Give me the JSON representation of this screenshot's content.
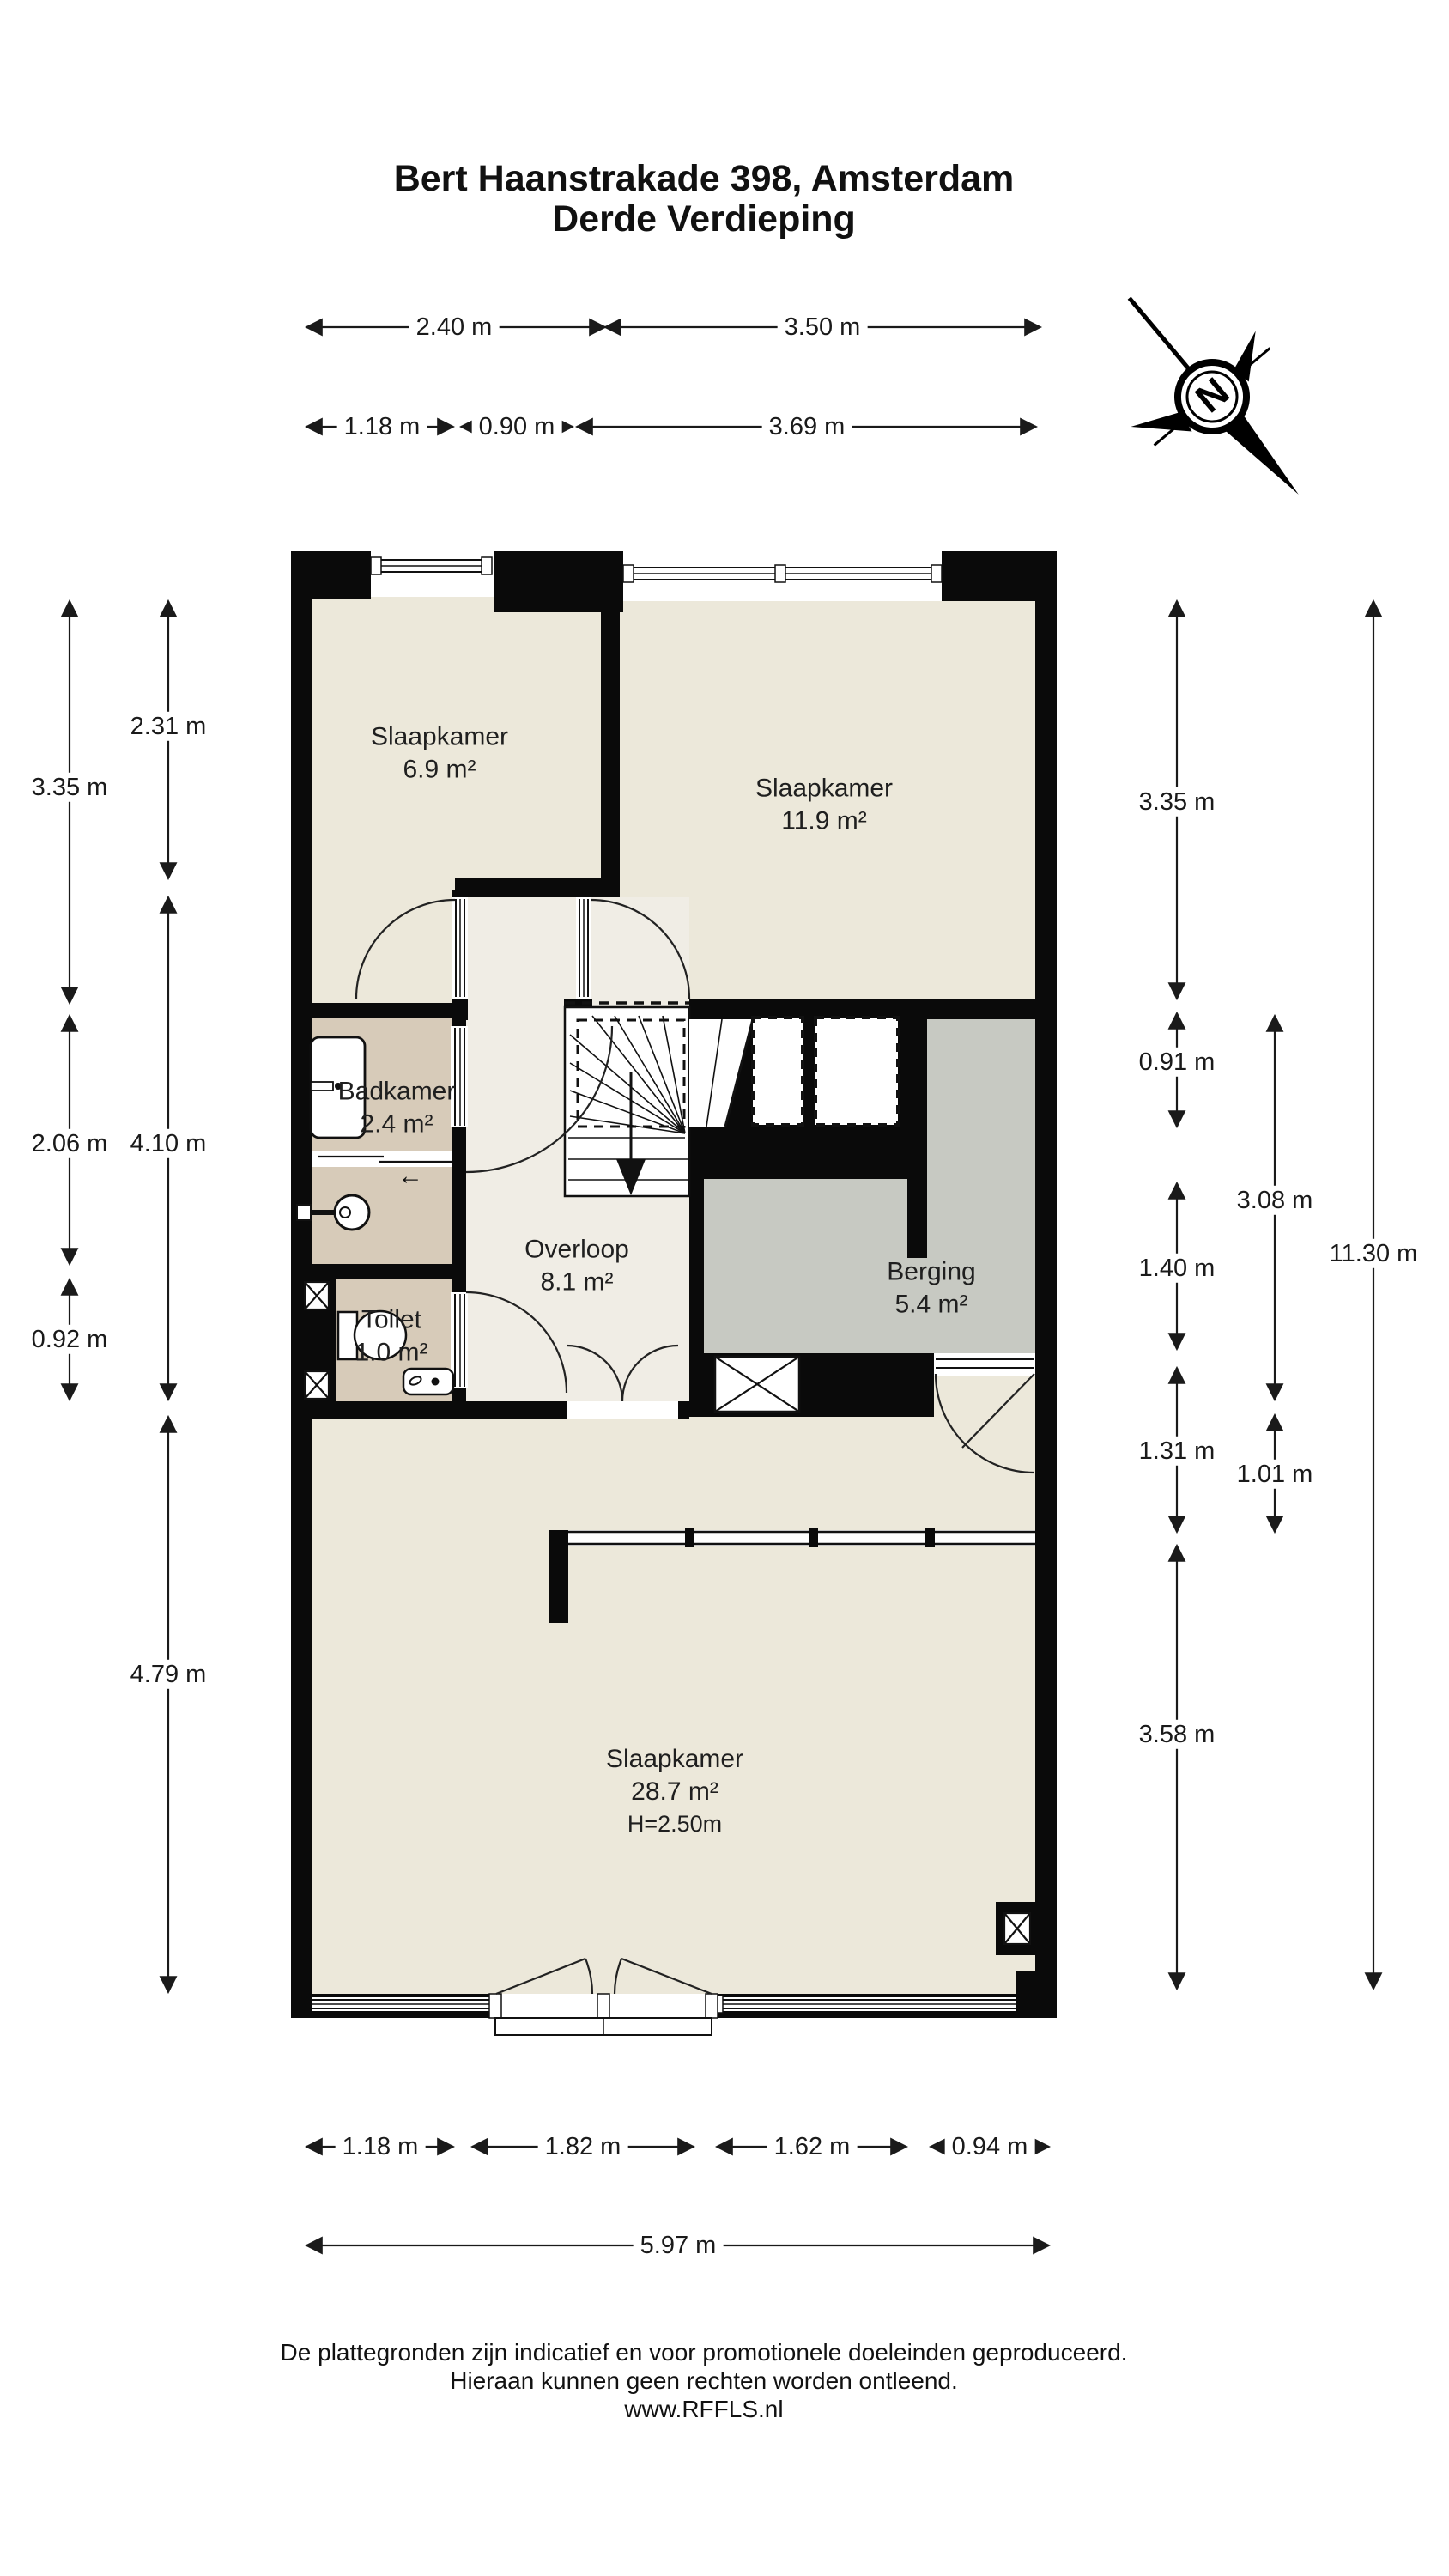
{
  "title": {
    "line1": "Bert Haanstrakade 398, Amsterdam",
    "line2": "Derde Verdieping"
  },
  "compass": {
    "label": "N"
  },
  "rooms": {
    "slaapkamer1": {
      "name": "Slaapkamer",
      "area": "6.9 m²"
    },
    "slaapkamer2": {
      "name": "Slaapkamer",
      "area": "11.9 m²"
    },
    "badkamer": {
      "name": "Badkamer",
      "area": "2.4 m²"
    },
    "toilet": {
      "name": "Toilet",
      "area": "1.0 m²"
    },
    "overloop": {
      "name": "Overloop",
      "area": "8.1 m²"
    },
    "berging": {
      "name": "Berging",
      "area": "5.4 m²"
    },
    "slaapkamer3": {
      "name": "Slaapkamer",
      "area": "28.7 m²",
      "height": "H=2.50m"
    }
  },
  "dimensions": {
    "top_row1": [
      "2.40 m",
      "3.50 m"
    ],
    "top_row2": [
      "1.18 m",
      "0.90 m",
      "3.69 m"
    ],
    "left_outer": [
      "3.35 m",
      "2.06 m",
      "0.92 m"
    ],
    "left_inner": [
      "2.31 m",
      "4.10 m",
      "4.79 m"
    ],
    "right_inner": [
      "3.35 m",
      "0.91 m",
      "1.40 m",
      "1.31 m",
      "3.58 m"
    ],
    "right_mid": [
      "3.08 m",
      "1.01 m"
    ],
    "right_outer": [
      "11.30 m"
    ],
    "bottom_row1": [
      "1.18 m",
      "1.82 m",
      "1.62 m",
      "0.94 m"
    ],
    "bottom_row2": [
      "5.97 m"
    ]
  },
  "symbols": {
    "slide_arrow": "←"
  },
  "footer": {
    "line1": "De plattegronden zijn indicatief en voor promotionele doeleinden geproduceerd.",
    "line2": "Hieraan kunnen geen rechten worden ontleend.",
    "line3": "www.RFFLS.nl"
  },
  "colors": {
    "wall": "#0a0a0a",
    "floor_bedroom": "#ECE8DA",
    "floor_hall": "#F0EDE5",
    "floor_bath": "#D7CBB9",
    "floor_storage": "#C7C9C2",
    "dimension_line": "#1a1a1a",
    "background": "#FFFFFF"
  }
}
